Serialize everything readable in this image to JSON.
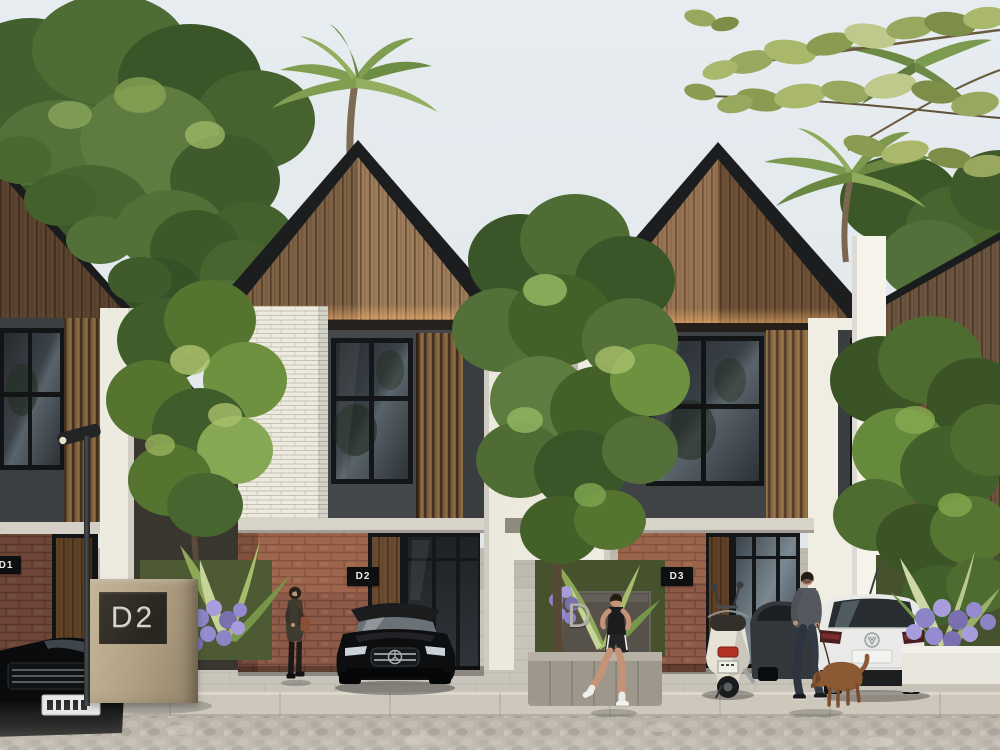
{
  "meta": {
    "kind": "architectural-exterior-rendering",
    "subject": "Row of modern two-storey tropical townhouses with gabled wood-slat roofs, street scene with cars, scooter and pedestrians"
  },
  "signs": {
    "monument": {
      "label": "D2"
    },
    "walkway": {
      "label": "D"
    },
    "unit_plates": [
      {
        "unit": "D1"
      },
      {
        "unit": "D2"
      },
      {
        "unit": "D3"
      }
    ]
  },
  "scene": {
    "houses": [
      "unit-D1-partial-left",
      "unit-D2-center",
      "unit-D3-right",
      "unit-partial-far-right"
    ],
    "people": [
      "woman-standing-by-brick-wall",
      "man-jogging",
      "man-walking-dog"
    ],
    "animals": [
      "brown-dog-on-leash"
    ],
    "vehicles": [
      "black-sedan-front-corner",
      "black-mercedes-coupe",
      "grey-hatchback",
      "white-hatchback-rear",
      "cream-scooter"
    ],
    "vegetation": [
      "tropical-canopy",
      "palm-trees",
      "street-trees",
      "banana-plants",
      "purple-flower-beds",
      "grass-verge"
    ],
    "street_furniture": [
      "street-lamp-left",
      "street-lamp-center",
      "monument-sign",
      "stone-planter",
      "white-planter"
    ]
  },
  "palette": {
    "sky": "#e4e9ee",
    "roof": "#1b1d1e",
    "wood": "#9c7c5a",
    "wood_dark": "#6b5038",
    "wall_dark": "#45484b",
    "wall_white": "#efede3",
    "brick": "#8d5a47",
    "glass": "#2c3237",
    "foliage_dark": "#3a5628",
    "foliage": "#527038",
    "foliage_light": "#87a455",
    "pavement": "#c9c4ba",
    "curb": "#cdc7bb",
    "road": "#b3ada2",
    "purple": "#8d84c6",
    "plate_bg": "#0e0f10",
    "plate_fg": "#ececea",
    "monument_face": "#b3a386",
    "sign_face": "#565149",
    "accent_warm": "#ffb96e"
  }
}
